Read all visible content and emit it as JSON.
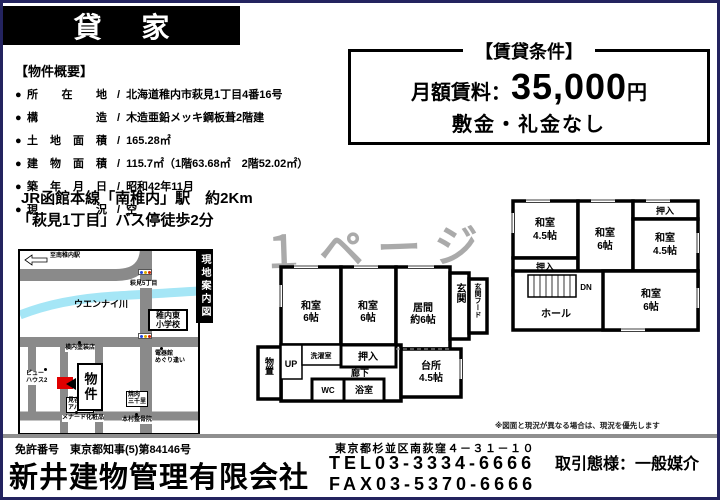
{
  "banner": {
    "title": "貸 家"
  },
  "watermark": "１ページ",
  "conditions": {
    "title": "【賃貸条件】",
    "rent_label": "月額賃料：",
    "rent_value": "35,000",
    "rent_unit": "円",
    "deposit": "敷金・礼金なし"
  },
  "overview": {
    "title": "【物件概要】",
    "bullet": "●",
    "separator": "/",
    "rows": [
      {
        "label": "所在地",
        "value": "北海道稚内市萩見1丁目4番16号"
      },
      {
        "label": "構造",
        "value": "木造亜鉛メッキ鋼板葺2階建"
      },
      {
        "label": "土地面積",
        "value": "165.28㎡"
      },
      {
        "label": "建物面積",
        "value": "115.7㎡（1階63.68㎡　2階52.02㎡）"
      },
      {
        "label": "築年月日",
        "value": "昭和42年11月"
      },
      {
        "label": "現況",
        "value": "空"
      }
    ]
  },
  "access": {
    "line1": "JR函館本線「南稚内」駅　約2Km",
    "line2": "「萩見1丁目」バス停徒歩2分"
  },
  "map": {
    "strip": "現地案内図",
    "to_station": "至南稚内駅",
    "intersection": "萩見5丁目",
    "river": "ウエンナイ川",
    "school_line1": "稚内東",
    "school_line2": "小学校",
    "property": "物件",
    "poi_paint": "横内塗装店",
    "poi_viewhouse_1": "ビュー",
    "poi_viewhouse_2": "ハウス2",
    "poi_denki_1": "電器館",
    "poi_denki_2": "めぐり逢い",
    "poi_apart_1": "見谷",
    "poi_apart_2": "アパート",
    "poi_yakiniku_1": "焼肉",
    "poi_yakiniku_2": "三千里",
    "poi_menard": "メナード化粧品",
    "poi_seikotsu": "本村整骨院"
  },
  "plan1f": {
    "washitsu_left_1": "和室",
    "washitsu_left_2": "6帖",
    "washitsu_mid_1": "和室",
    "washitsu_mid_2": "6帖",
    "living_1": "居間",
    "living_2": "約6帖",
    "genkan": "玄関",
    "genkan_hood": "玄関フード",
    "storage": "物置",
    "stairs": "UP",
    "laundry": "洗濯室",
    "oshiire": "押入",
    "hallway": "廊下",
    "wc": "WC",
    "bath": "浴室",
    "kitchen_1": "台所",
    "kitchen_2": "4.5帖"
  },
  "plan2f": {
    "washitsu_tl_1": "和室",
    "washitsu_tl_2": "4.5帖",
    "oshiire_left": "押入",
    "washitsu_mid_1": "和室",
    "washitsu_mid_2": "6帖",
    "oshiire_top": "押入",
    "washitsu_r_1": "和室",
    "washitsu_r_2": "4.5帖",
    "stairs": "DN",
    "hall": "ホール",
    "washitsu_br_1": "和室",
    "washitsu_br_2": "6帖"
  },
  "note": "※図面と現況が異なる場合は、現況を優先します",
  "footer": {
    "license": "免許番号　東京都知事(5)第84146号",
    "company": "新井建物管理有限会社",
    "address": "東京都杉並区南荻窪４－３１－１０",
    "tel": "TEL03-3334-6666",
    "fax": "FAX03-5370-6666",
    "transaction": "取引態様：一般媒介"
  }
}
